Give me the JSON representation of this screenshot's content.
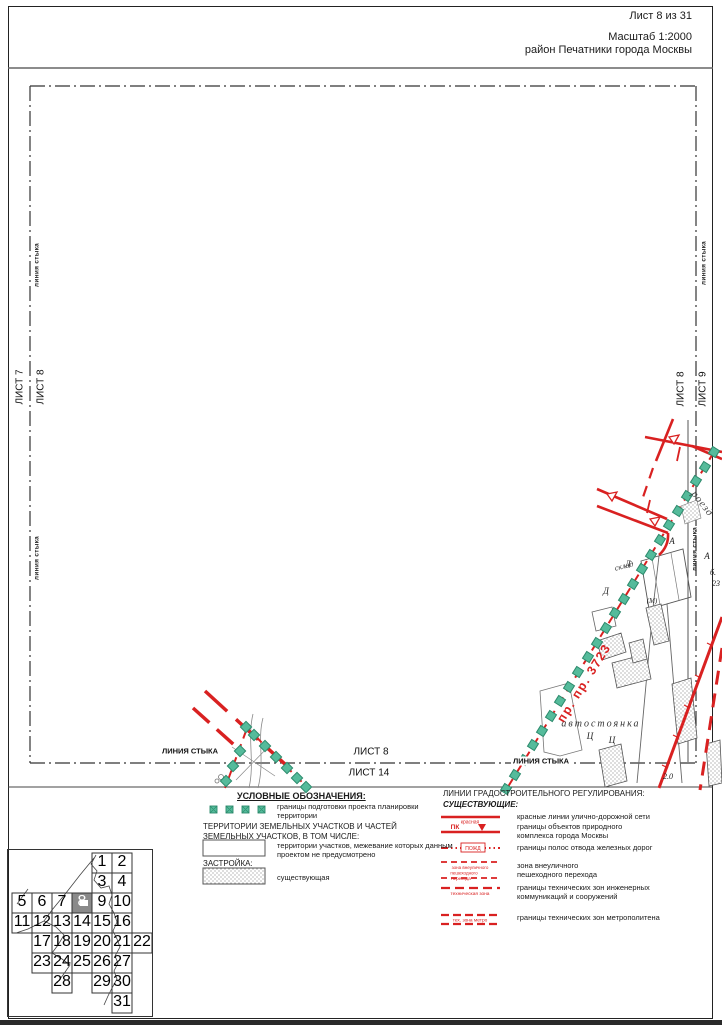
{
  "header": {
    "sheet": "Лист 8 из 31",
    "scale": "Масштаб 1:2000",
    "district": "район Печатники города Москвы"
  },
  "edges": {
    "junction_small": "линия стыка",
    "junction_caps": "ЛИНИЯ СТЫКА",
    "left_outer_sheet": "ЛИСТ 7",
    "left_inner_sheet": "ЛИСТ 8",
    "right_inner_sheet": "ЛИСТ 8",
    "right_outer_sheet": "ЛИСТ 9",
    "bottom_inner_sheet": "ЛИСТ 8",
    "bottom_outer_sheet": "ЛИСТ 14"
  },
  "map_texts": {
    "street": "роезд",
    "design_passage": "пр. пр. 3723",
    "parking": "автостоянка",
    "warehouse": "склад",
    "letter_a_1": "А",
    "letter_a_2": "А",
    "letter_d_1": "Д",
    "letter_d_2": "Д",
    "letter_ts_1": "Ц",
    "letter_ts_2": "Ц",
    "metro_mark": "(М)",
    "note_b": "б.",
    "note_23": "23",
    "note_20": "2.0"
  },
  "legend": {
    "title": "УСЛОВНЫЕ ОБОЗНАЧЕНИЯ:",
    "boundary_label": "границы подготовки проекта планировки территории",
    "territories_heading": "ТЕРРИТОРИИ ЗЕМЕЛЬНЫХ УЧАСТКОВ И ЧАСТЕЙ ЗЕМЕЛЬНЫХ УЧАСТКОВ, В ТОМ ЧИСЛЕ:",
    "territories_item": "территории участков, межевание которых данным проектом не предусмотрено",
    "built_heading": "ЗАСТРОЙКА:",
    "built_item": "существующая"
  },
  "regulation": {
    "title": "ЛИНИИ ГРАДОСТРОИТЕЛЬНОГО РЕГУЛИРОВАНИЯ:",
    "subtitle": "СУЩЕСТВУЮЩИЕ:",
    "sym_krasnaya": "красная",
    "sym_pk": "ПК",
    "sym_pozhd": "ПОЖД",
    "sym_zone1": "зона  внеуличного",
    "sym_zone2": "пешеходного",
    "sym_zone3": "перехода",
    "sym_tech": "техническая зона",
    "sym_metro": "тех. зона метро",
    "items": [
      "красные линии улично-дорожной сети",
      "границы объектов природного комплекса города Москвы",
      "границы полос отвода железных дорог",
      "зона  внеуличного пешеходного перехода",
      "границы технических зон инженерных коммуникаций и сооружений",
      "границы технических зон метрополитена"
    ]
  },
  "sheet_index": {
    "current": "8",
    "cells": [
      "1",
      "2",
      "3",
      "4",
      "5",
      "6",
      "7",
      "8",
      "9",
      "10",
      "11",
      "12",
      "13",
      "14",
      "15",
      "16",
      "17",
      "18",
      "19",
      "20",
      "21",
      "22",
      "23",
      "24",
      "25",
      "26",
      "27",
      "28",
      "29",
      "30",
      "31"
    ]
  },
  "colors": {
    "red_line": "#d92121",
    "boundary_teal": "#55bb9b"
  }
}
